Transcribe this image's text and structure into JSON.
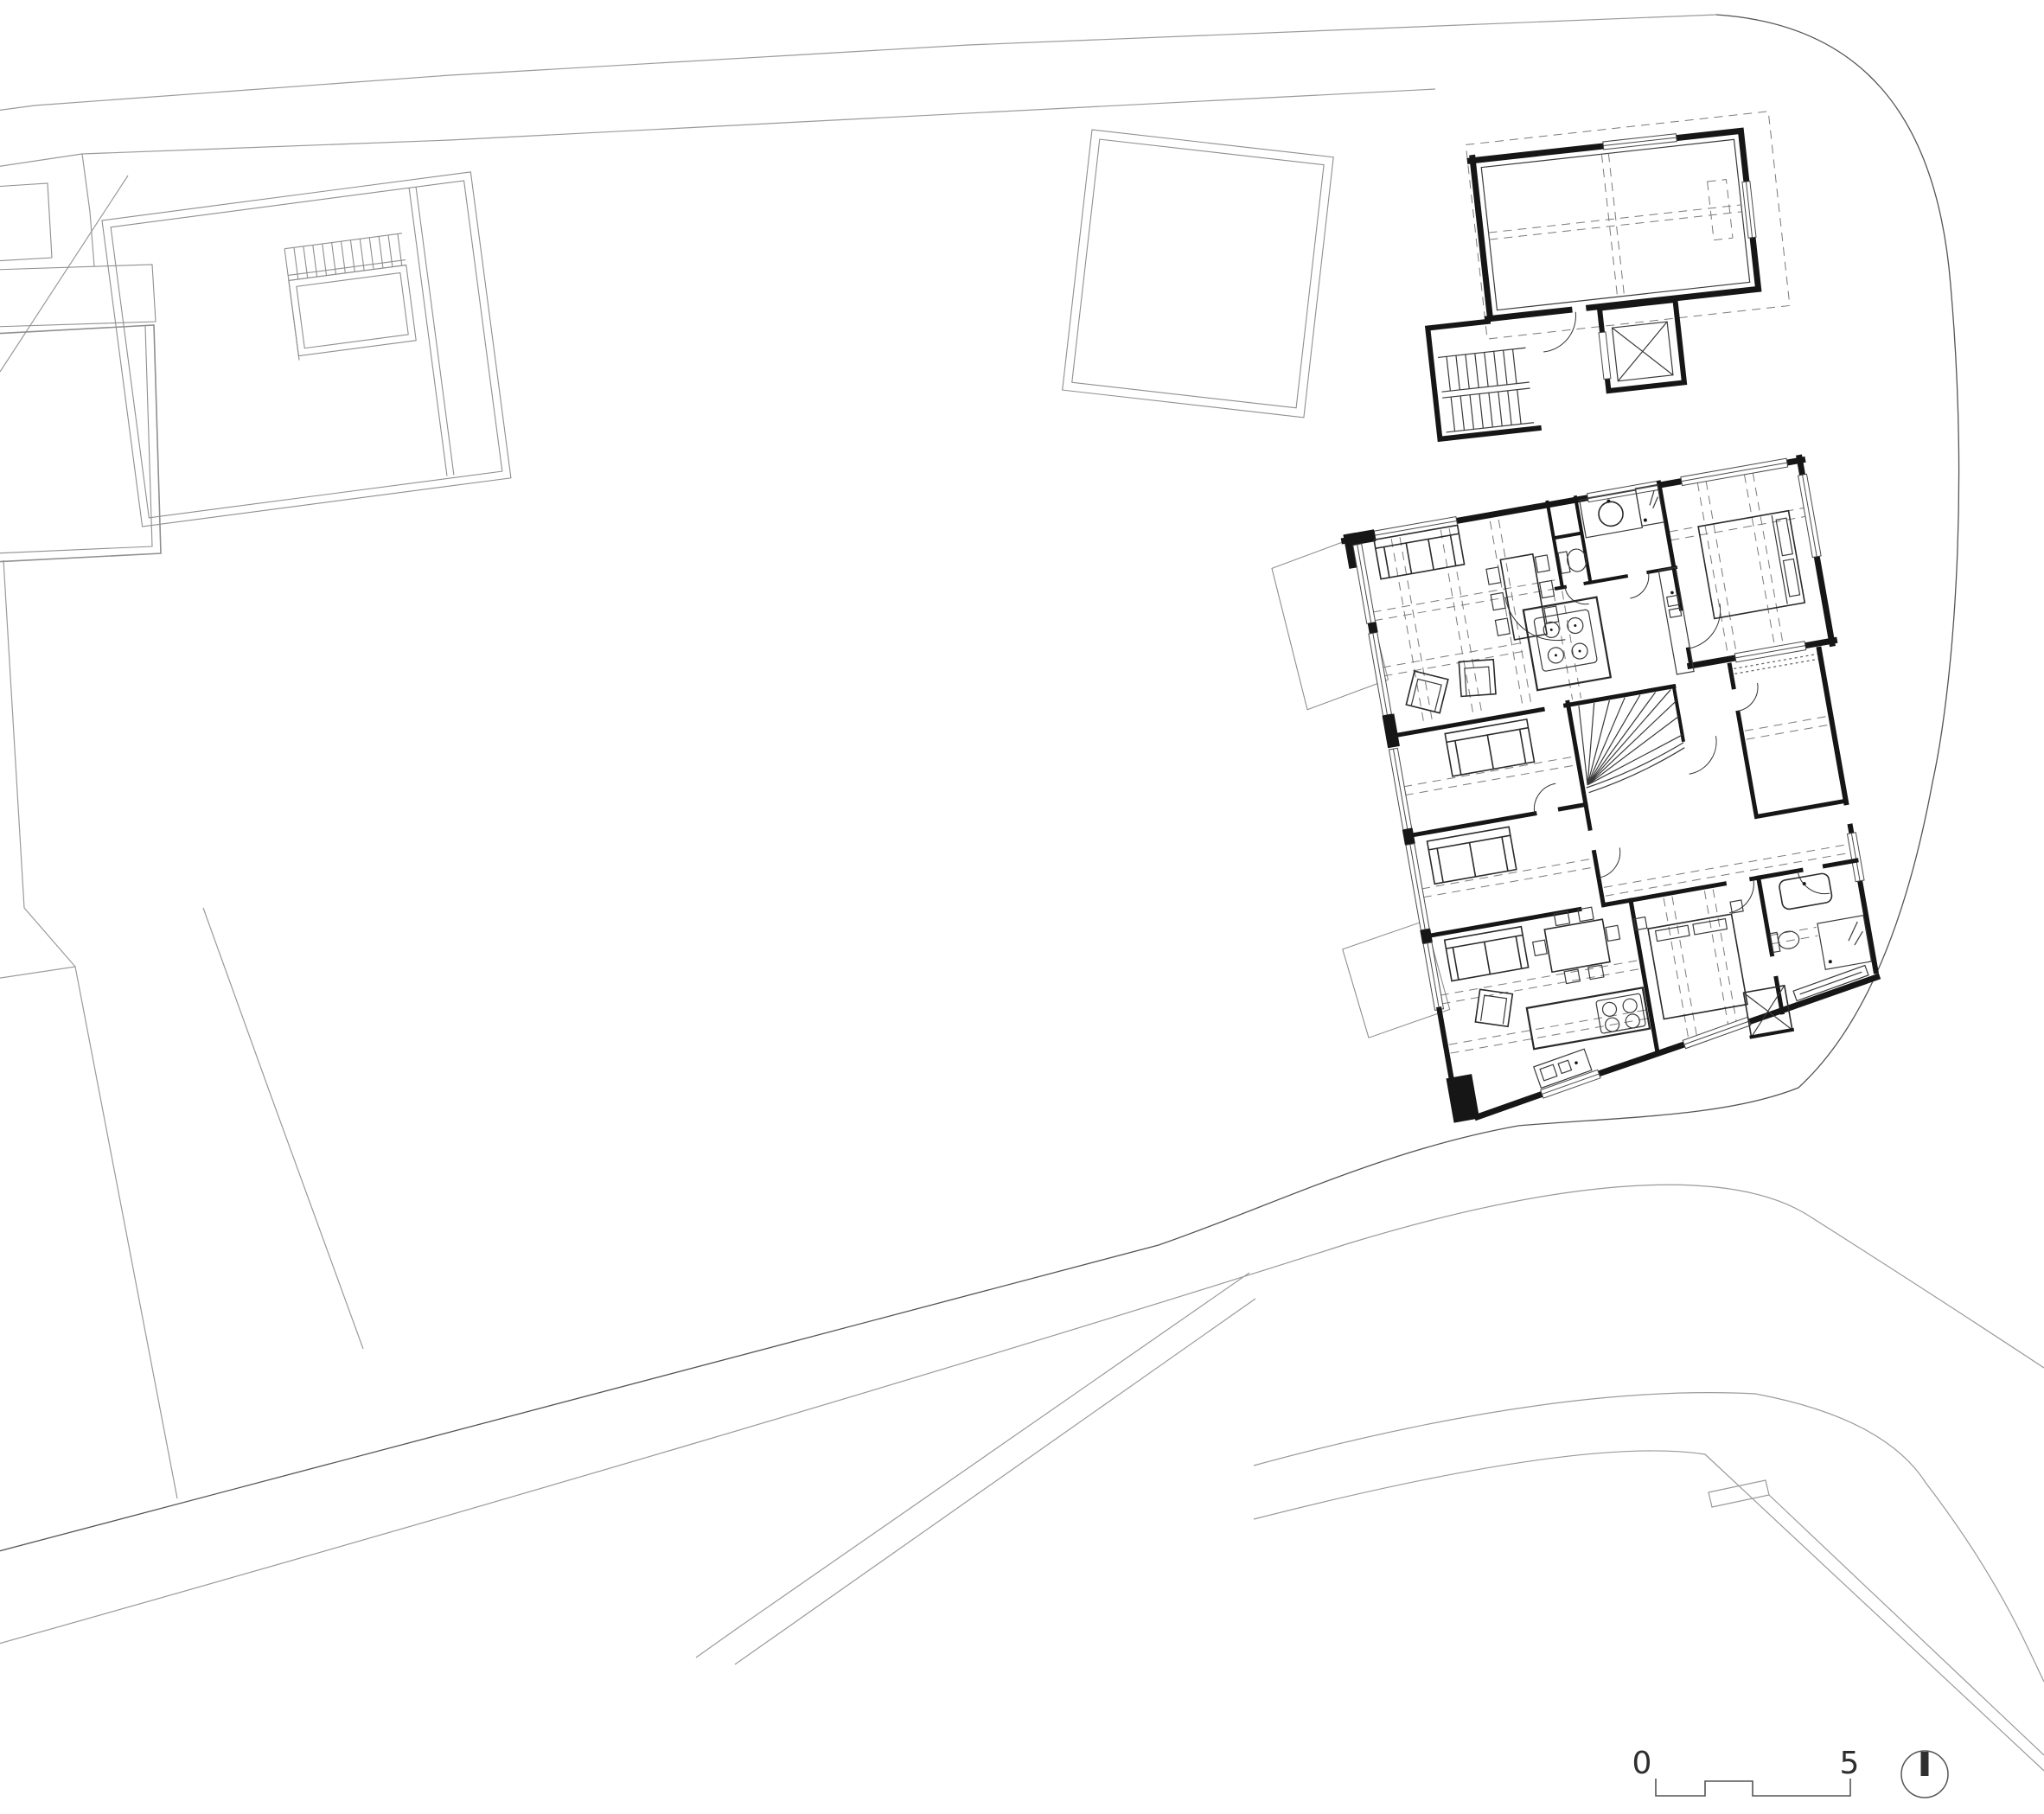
{
  "document": {
    "kind": "architectural floor plan drawing",
    "content": "site plan with one detailed apartment floor level, neighbouring buildings, streets and parcel boundaries"
  },
  "scale_bar": {
    "start_label": "0",
    "end_label": "5"
  },
  "north_arrow": {
    "icon": "north-arrow-icon",
    "direction": "up"
  },
  "colors": {
    "paper": "#ffffff",
    "wall": "#161616",
    "medium": "#555555",
    "light": "#8f8f8f",
    "street": "#9a9a9a",
    "dash": "#7a7a7a"
  }
}
